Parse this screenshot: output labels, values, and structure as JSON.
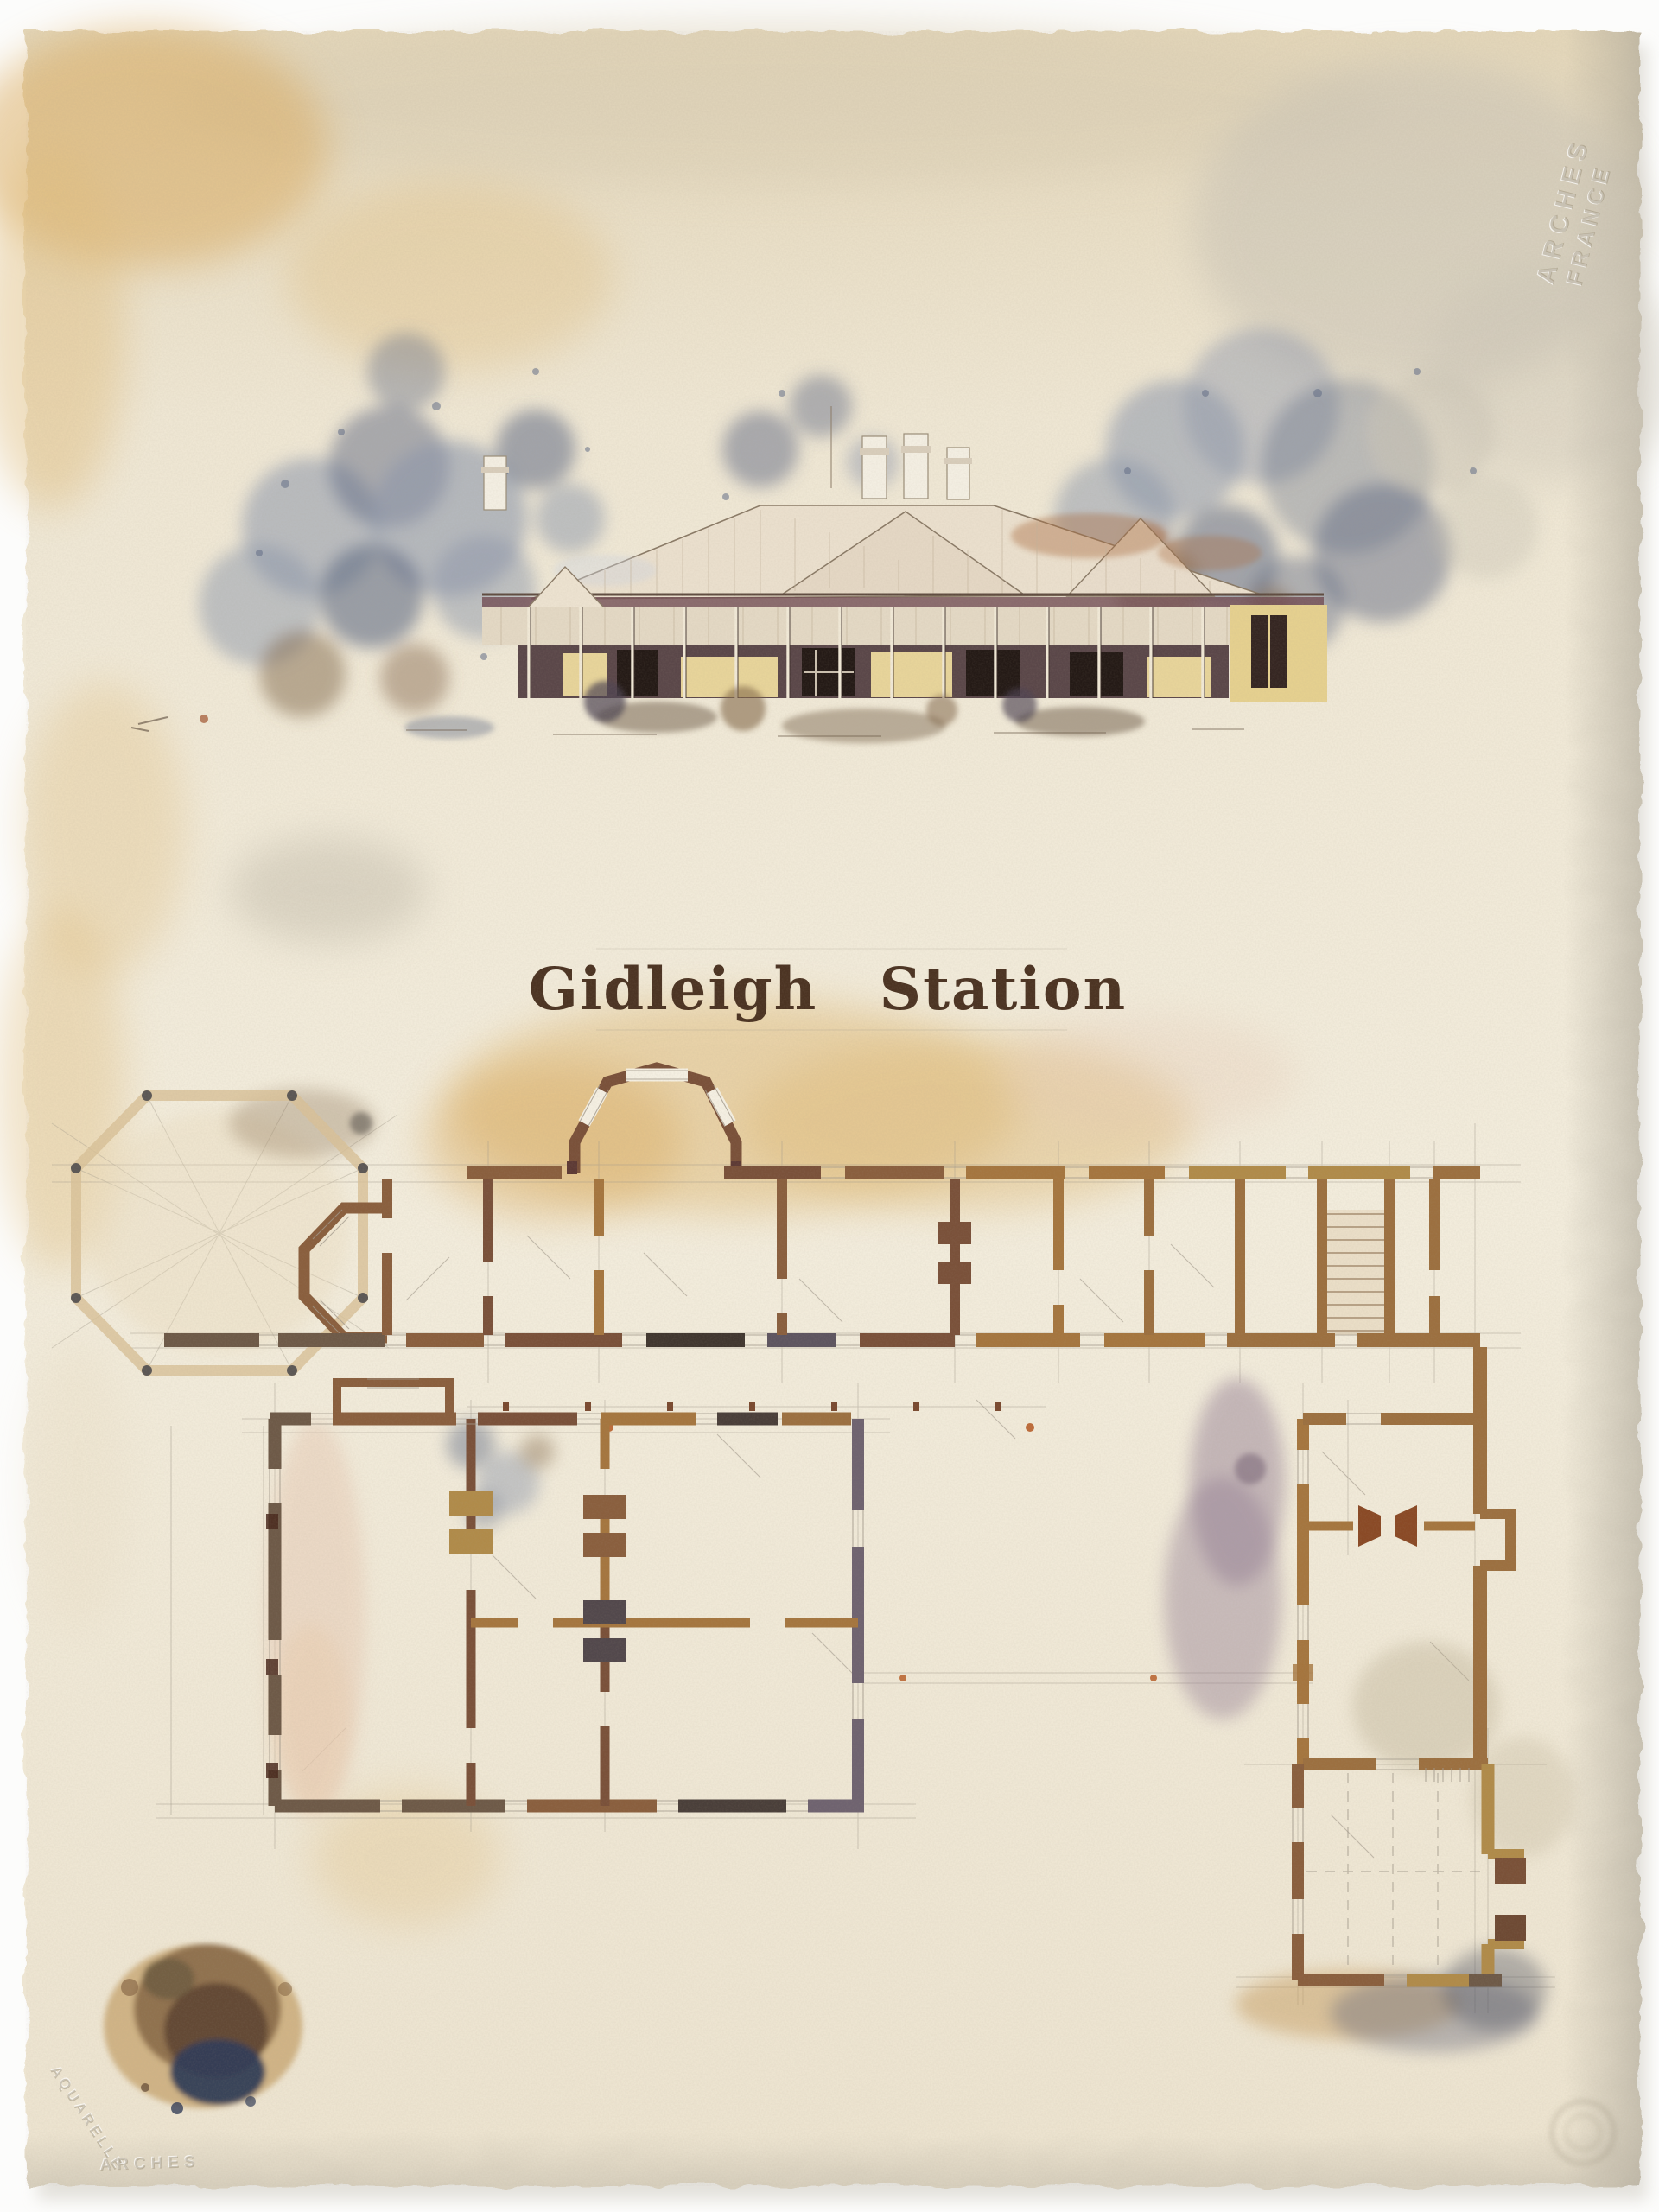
{
  "artwork": {
    "title": "Gidleigh Station"
  },
  "paper_stamps": {
    "top_right": [
      "ARCHES",
      "FRANCE"
    ],
    "bottom_left_diagonal": "AQUARELLE",
    "bottom_left_horizontal": "ARCHES"
  },
  "palette": {
    "page-bg": "#fcfcfa",
    "paper-base": "#efe7d5",
    "paper-light": "#f4efe2",
    "paper-tan": "#dfcca6",
    "paper-grey": "#c9c3b5",
    "wash-ochre": "#e0bd7e",
    "wash-amber": "#d9a95c",
    "wash-blue": "#8a93a8",
    "wash-slate": "#5d6880",
    "wash-indigo": "#333d57",
    "wash-mauve": "#8e7890",
    "wash-pink": "#e6c9b4",
    "wall-brown": "#8a5f3e",
    "wall-sienna": "#7a513a",
    "wall-ochre": "#a5763f",
    "wall-gold": "#b08b4a",
    "wall-umber": "#6e5a48",
    "wall-charcoal": "#453b36",
    "wall-grey": "#6f6370",
    "wall-tan": "#9c7040",
    "wall-rust": "#8a4a26",
    "stone": "#d8c097",
    "pencil": "#a29a8c",
    "ink-title": "#4c3423",
    "emboss": "#8d8066",
    "roof-pale": "#eadfcd",
    "roof-rust": "#a96a3e",
    "verandah-maroon": "#714b52",
    "shadow-maroon": "#463036",
    "wall-cream": "#e7d49a",
    "window-dark": "#241a16",
    "tree-blue": "#8d97ab",
    "tree-slate": "#616c85",
    "tree-brown": "#82674a"
  }
}
